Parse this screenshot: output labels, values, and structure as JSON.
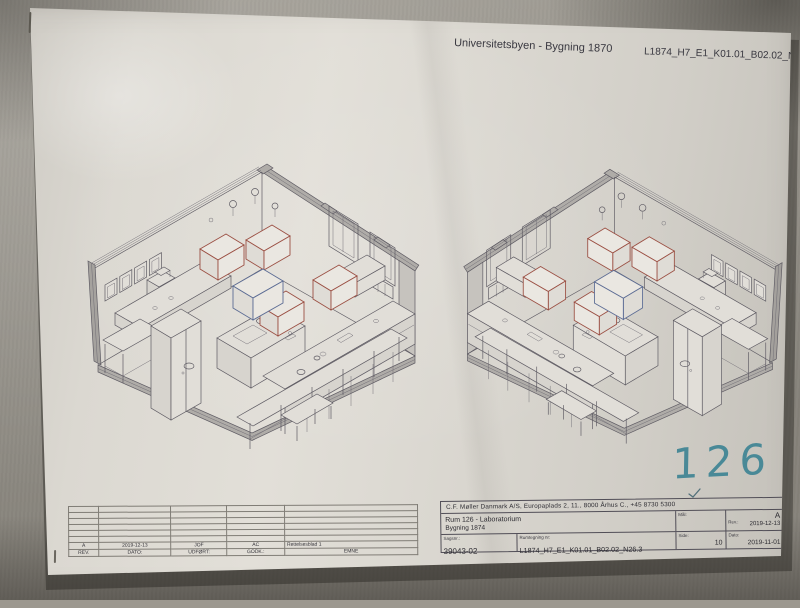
{
  "header": {
    "project": "Universitetsbyen - Bygning 1870",
    "drawing_code": "L1874_H7_E1_K01.01_B02.02_N26.3"
  },
  "handwritten": {
    "room_number": "126"
  },
  "title_block": {
    "company": "C.F. Møller Danmark A/S, Europaplads 2, 11., 8000 Århus C., +45 8730 5300",
    "room_title": "Rum 126 - Laboratorium",
    "building": "Bygning 1874",
    "scale_label": "Mål:",
    "rev_label": "Rev.:",
    "rev_value": "A",
    "rev_date": "2019-12-13",
    "case_label": "Sagsnr.:",
    "case_value": "39043-02",
    "drawing_no_label": "Rumtegning nr:",
    "drawing_no_value": "L1874_H7_E1_K01.01_B02.02_N26.3",
    "page_label": "Side:",
    "page_value": "10",
    "date_label": "Dato:",
    "date_value": "2019-11-01"
  },
  "revision_table": {
    "headers": [
      "REV.",
      "DATO:",
      "UDFØRT:",
      "GODK.:",
      "EMNE"
    ],
    "rows": [
      [
        "A",
        "2019-12-13",
        "JOF",
        "AC",
        "Rettelsesblad 1"
      ]
    ],
    "empty_row_count": 6
  },
  "colors": {
    "accent_red": "#9b4f43",
    "accent_blue": "#5c6c94",
    "marker_teal": "#3f8494",
    "drawing_line": "#5e5b63",
    "paper": "#dcd9d2",
    "wall": "#9c988f"
  }
}
